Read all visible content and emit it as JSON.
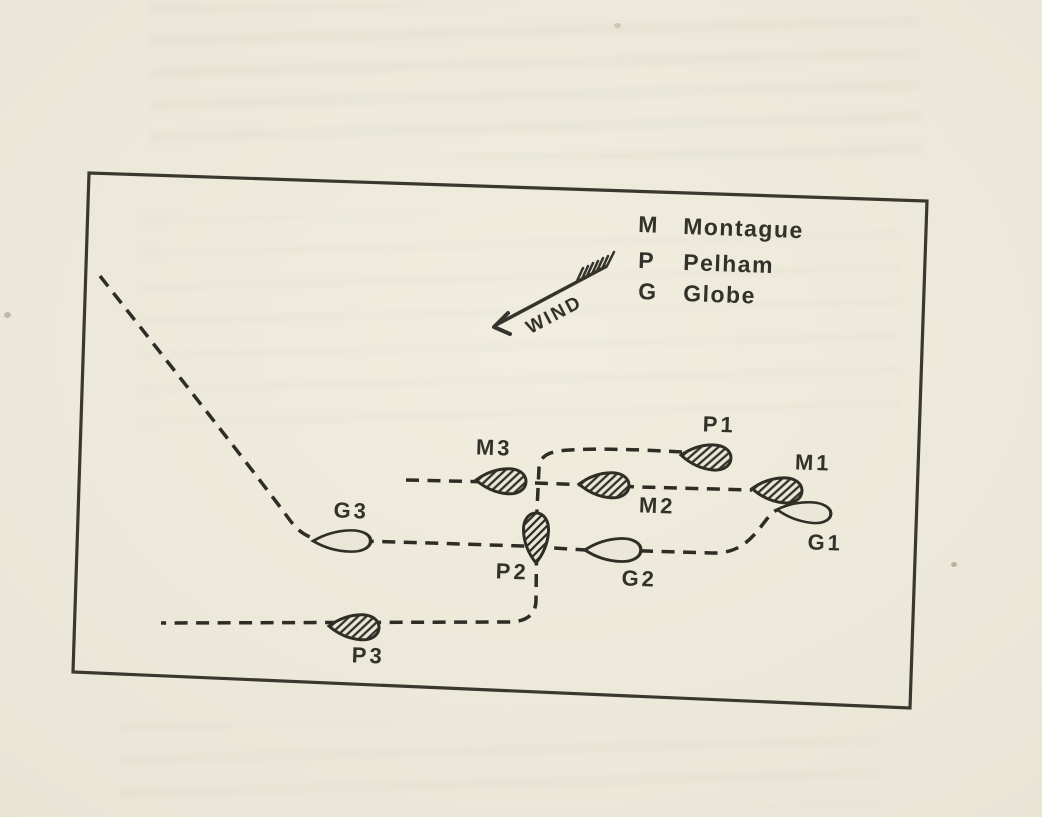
{
  "palette": {
    "paper": "#ebe7d8",
    "ink": "#34312a",
    "track_ink": "#2e2c25"
  },
  "legend": {
    "entries": [
      {
        "key": "M",
        "name": "Montague"
      },
      {
        "key": "P",
        "name": "Pelham"
      },
      {
        "key": "G",
        "name": "Globe"
      }
    ]
  },
  "wind": {
    "label": "WIND"
  },
  "boats": [
    {
      "id": "M1",
      "label": "M1",
      "fleet": "Montague",
      "style": "hatched"
    },
    {
      "id": "M2",
      "label": "M2",
      "fleet": "Montague",
      "style": "hatched"
    },
    {
      "id": "M3",
      "label": "M3",
      "fleet": "Montague",
      "style": "hatched"
    },
    {
      "id": "P1",
      "label": "P1",
      "fleet": "Pelham",
      "style": "hatched"
    },
    {
      "id": "P2",
      "label": "P2",
      "fleet": "Pelham",
      "style": "hatched"
    },
    {
      "id": "P3",
      "label": "P3",
      "fleet": "Pelham",
      "style": "hatched"
    },
    {
      "id": "G1",
      "label": "G1",
      "fleet": "Globe",
      "style": "outline"
    },
    {
      "id": "G2",
      "label": "G2",
      "fleet": "Globe",
      "style": "outline"
    },
    {
      "id": "G3",
      "label": "G3",
      "fleet": "Globe",
      "style": "outline"
    }
  ]
}
